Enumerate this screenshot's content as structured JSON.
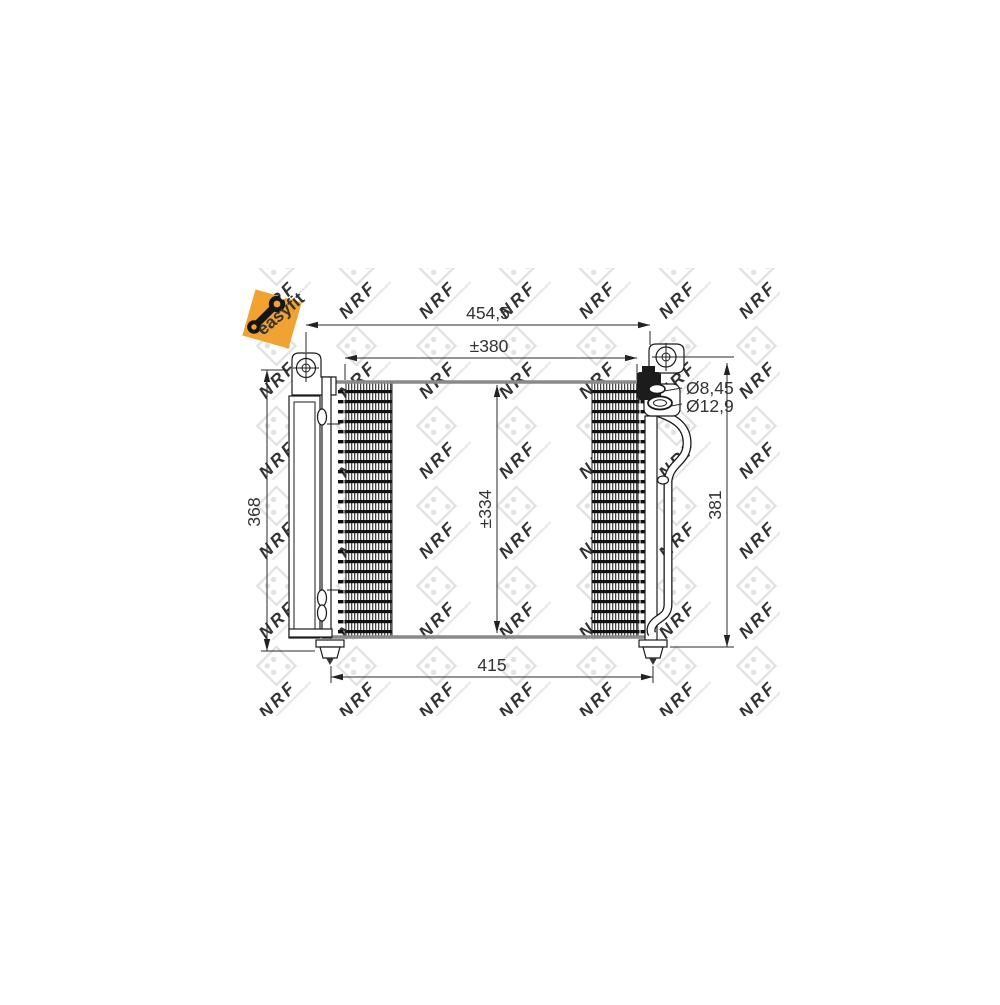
{
  "diagram": {
    "type": "technical-drawing",
    "subject": "automotive air-conditioning condenser, front and side views with dimensions",
    "dimensions": {
      "overall_width": "454,5",
      "mounting_width": "±380",
      "port_small_diameter": "Ø8,45",
      "port_large_diameter": "Ø12,9",
      "left_height": "368",
      "core_height": "±334",
      "right_height": "381",
      "bottom_width": "415"
    },
    "badge": {
      "label": "easyfit",
      "icon": "wrench-chain-link-icon",
      "background": "#F0A232",
      "icon_color": "#151515",
      "label_color": "#503A08"
    },
    "watermark": {
      "text": "NRF",
      "icon": "nrf-flag-logo-icon",
      "color": "#E2E2E2"
    },
    "colors": {
      "outline": "#1A1A1A",
      "dimension_lines": "#2A2A2A",
      "core_edge_gray": "#8A8A8A",
      "background": "#FFFFFF"
    }
  }
}
